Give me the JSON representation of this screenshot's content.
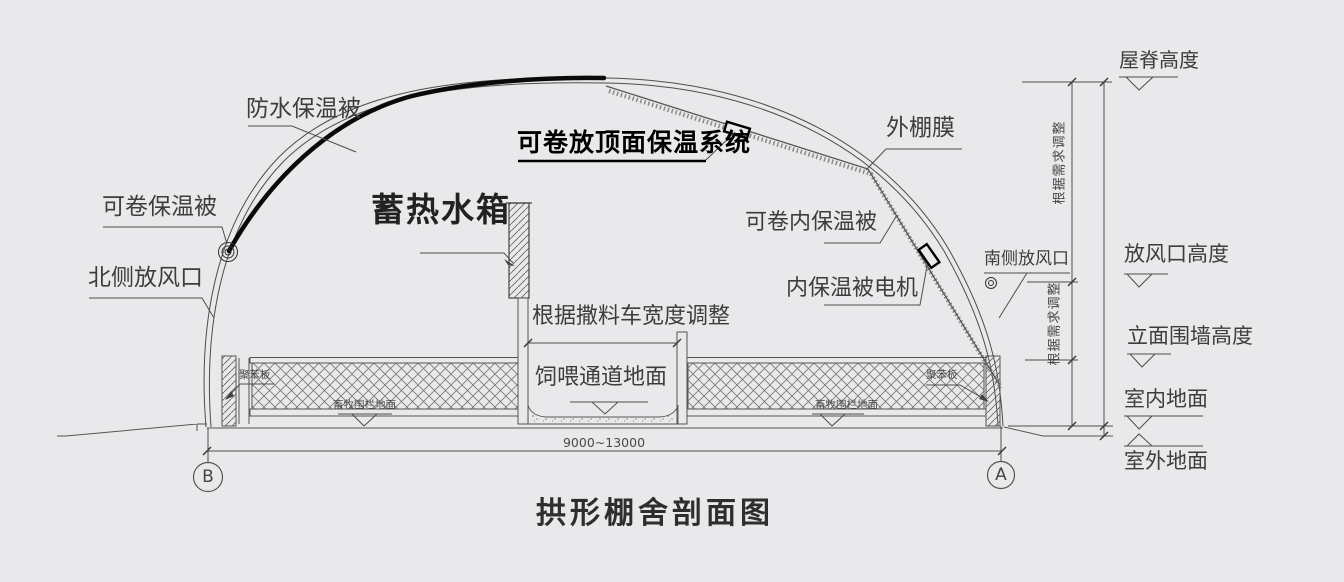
{
  "drawing_title": "拱形棚舍剖面图",
  "colors": {
    "background": "#e9e9eb",
    "line": "#4d4d4d",
    "text": "#3d3d3d",
    "highlight": "#000000"
  },
  "labels": {
    "waterproof_blanket": "防水保温被",
    "rollable_blanket": "可卷保温被",
    "north_vent": "北侧放风口",
    "water_tank": "蓄热水箱",
    "roof_insulation_system": "可卷放顶面保温系统",
    "outer_film": "外棚膜",
    "rollable_inner_blanket": "可卷内保温被",
    "inner_blanket_motor": "内保温被电机",
    "south_vent": "南侧放风口",
    "feed_truck_width_note": "根据撒料车宽度调整",
    "feeding_passage_floor": "饲喂通道地面",
    "wall_material": "聚苯板",
    "livestock_floor": "畜牧围栏地面",
    "adjust_note": "根据需求调整"
  },
  "levels": {
    "ridge_height": "屋脊高度",
    "vent_height": "放风口高度",
    "facade_wall_height": "立面围墙高度",
    "indoor_floor": "室内地面",
    "outdoor_floor": "室外地面"
  },
  "dimensions": {
    "span": "9000~13000"
  },
  "axes": {
    "left": "B",
    "right": "A"
  }
}
